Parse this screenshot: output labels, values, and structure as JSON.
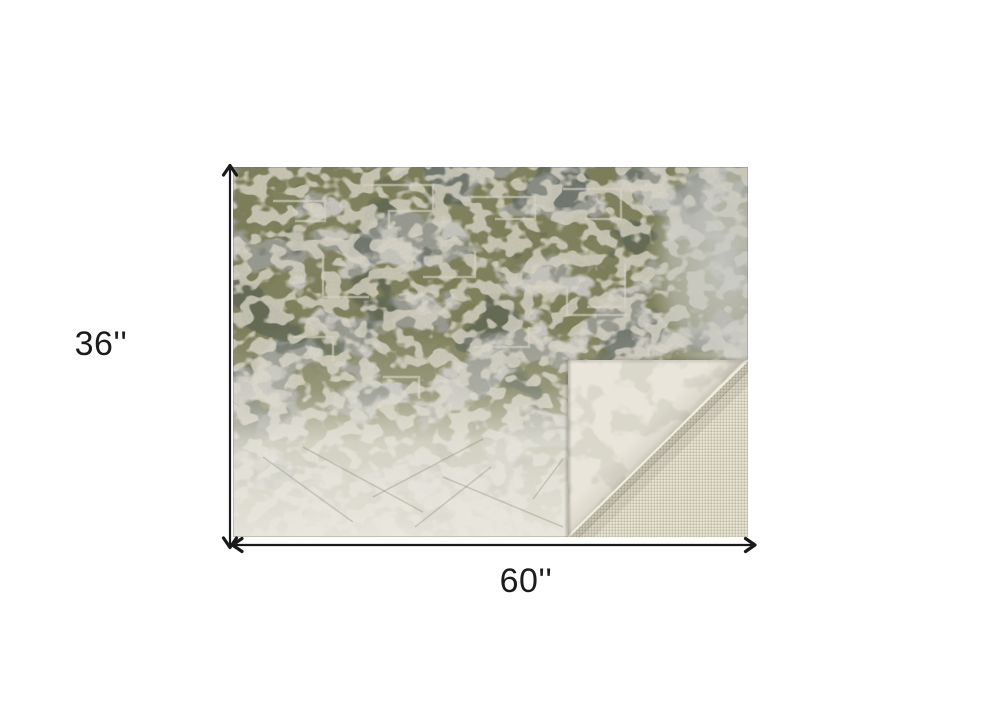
{
  "page": {
    "background_color": "#ffffff"
  },
  "product_image": {
    "description": "Abstract olive green and gray distressed area rug, bottom-right corner folded over showing non-slip mesh backing",
    "rug": {
      "colors": {
        "base": "#c8c7bf",
        "gray_blotch": "#96988e",
        "olive_blotch": "#7c7e57",
        "dark_accent": "#4d5750",
        "cream_detail": "#ddd9cb",
        "bottom_fade": "#e9e7de"
      }
    },
    "folded_corner": {
      "flap_color": "#e9e5da",
      "flap_marking_color": "#cecdc0",
      "mesh_base": "#d7d3c1",
      "mesh_light": "#efecde",
      "mesh_dark": "#b6b29e",
      "fold_edge_highlight": "#f0ecdf"
    }
  },
  "dimension_annotations": {
    "arrow_color": "#1a1a1a",
    "height": {
      "label": "36''",
      "value_inches": 36
    },
    "width": {
      "label": "60''",
      "value_inches": 60
    }
  }
}
